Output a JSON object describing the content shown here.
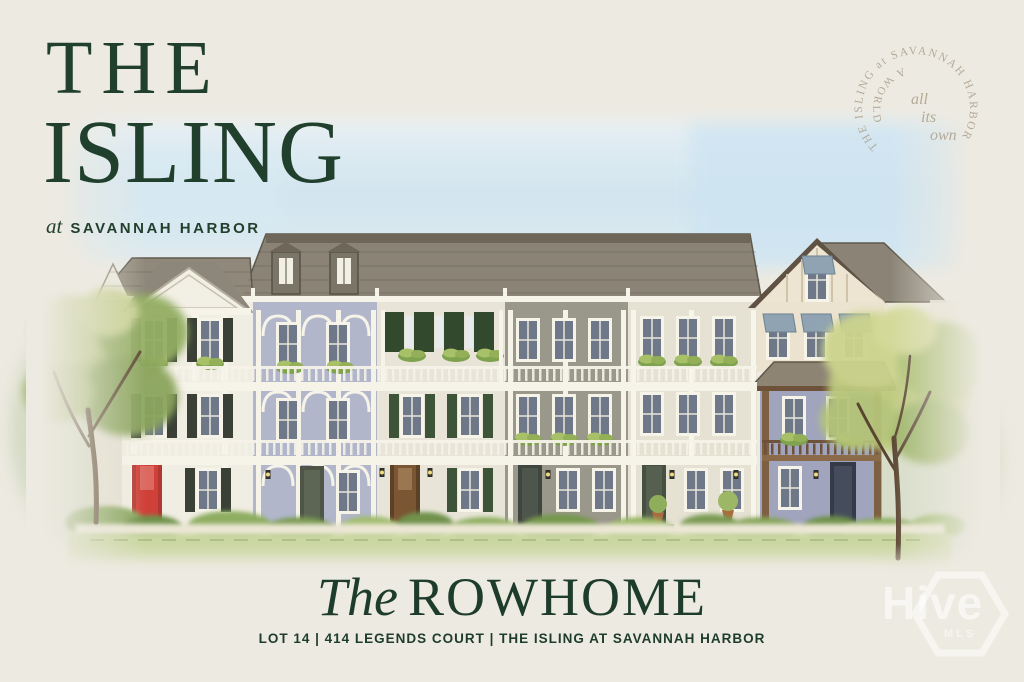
{
  "page": {
    "background_color": "#edeae1",
    "accent_green": "#1e3c2b"
  },
  "logo": {
    "line1": "THE",
    "line2": "ISLING",
    "tagline_prefix": "at",
    "tagline_location": "SAVANNAH HARBOR"
  },
  "seal": {
    "ring_text": "THE ISLING at SAVANNAH HARBOR",
    "inner_arc_text": "A WORLD",
    "center_line1": "all",
    "center_line2": "its",
    "center_line3": "own",
    "text_color": "#b4aa98"
  },
  "headline": {
    "title_prefix": "The",
    "title_main": "ROWHOME",
    "address_line": "LOT 14 | 414 LEGENDS COURT | THE ISLING AT SAVANNAH HARBOR"
  },
  "watermark": {
    "brand": "Hive",
    "sub_label": "MLS"
  },
  "illustration": {
    "caption": "Watercolor street elevation of six three-story rowhome units with porches, balconies, shuttered windows, window boxes, a red front door, flanking trees, shrubs and lawn",
    "notable_colors": {
      "sky_wash": "#cfe4f1",
      "roof_gray": "#8a8376",
      "lavender_unit": "#b1b6cb",
      "front_door_red": "#cf4038",
      "shutter_green": "#33492e",
      "porch_brown": "#7d5f41",
      "foliage_green": "#9db46e",
      "grass_green": "#cbd7a2"
    }
  }
}
